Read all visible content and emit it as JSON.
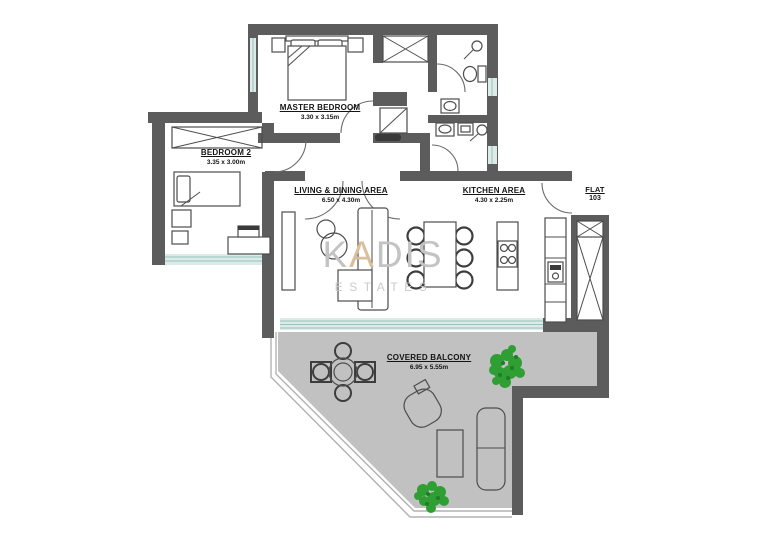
{
  "colors": {
    "wall": "#5c5c5c",
    "balcony": "#c1c1c1",
    "window": "#dcebe8",
    "window_line": "#96c3bc",
    "plant": "#2f9e33",
    "plant_dark": "#1e7d28",
    "line": "#4d4d4d",
    "watermark": "#c3c3c3",
    "watermark_accent": "#d9c09a"
  },
  "rooms": {
    "master_bedroom": {
      "name": "MASTER BEDROOM",
      "dims": "3.30 x 3.15m"
    },
    "bedroom_2": {
      "name": "BEDROOM 2",
      "dims": "3.35 x 3.00m"
    },
    "living_dining": {
      "name": "LIVING & DINING AREA",
      "dims": "6.50 x 4.30m"
    },
    "kitchen": {
      "name": "KITCHEN AREA",
      "dims": "4.30 x 2.25m"
    },
    "covered_balcony": {
      "name": "COVERED BALCONY",
      "dims": "6.95 x 5.55m"
    }
  },
  "flat": {
    "label": "FLAT",
    "number": "103"
  },
  "watermark": {
    "k": "K",
    "a": "A",
    "dis": "DIS",
    "subtitle": "ESTATES"
  }
}
